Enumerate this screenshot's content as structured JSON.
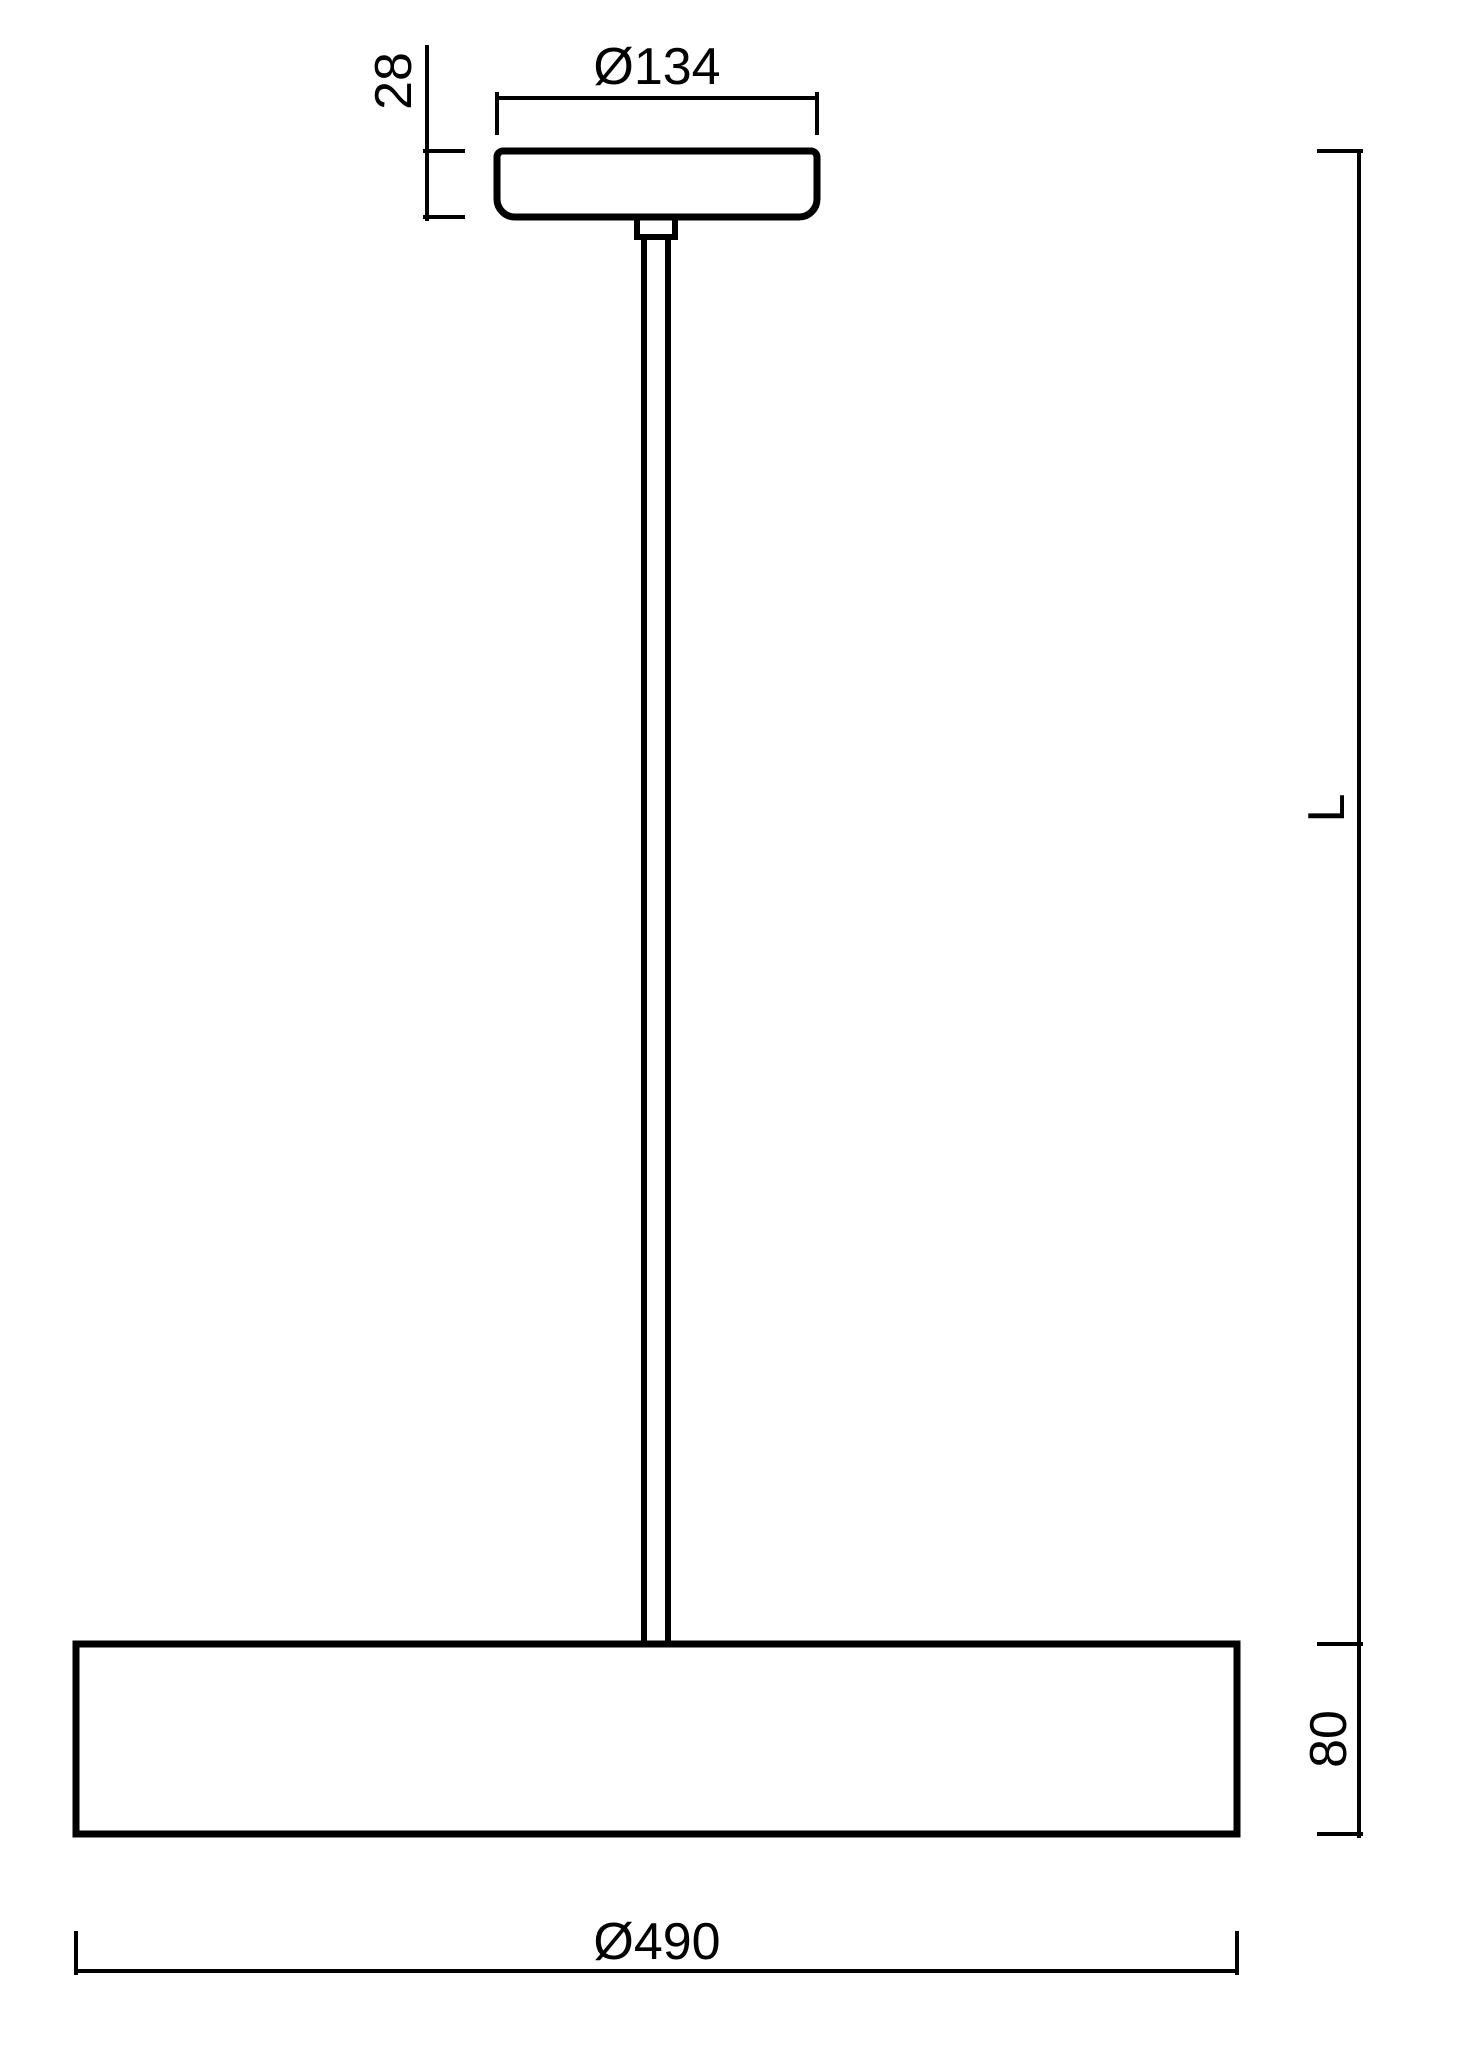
{
  "colors": {
    "ink": "#000000",
    "background": "#ffffff"
  },
  "drawing": {
    "dimensions": {
      "canopy_diameter": "Ø134",
      "canopy_height": "28",
      "suspension_length": "L",
      "shade_height": "80",
      "shade_diameter": "Ø490"
    }
  }
}
